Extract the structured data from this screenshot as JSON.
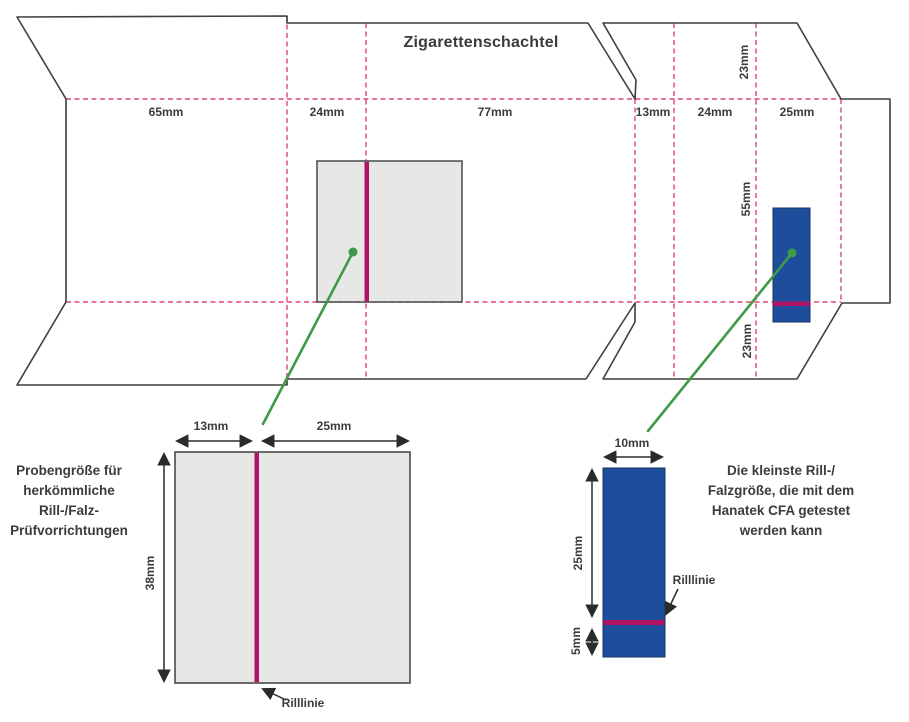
{
  "title": "Zigarettenschachtel",
  "box_template": {
    "panel_widths": [
      "65mm",
      "24mm",
      "77mm",
      "13mm",
      "24mm",
      "25mm"
    ],
    "side_heights": [
      "23mm",
      "55mm",
      "23mm"
    ]
  },
  "left_sample": {
    "caption_lines": [
      "Probengröße für",
      "herkömmliche",
      "Rill-/Falz-",
      "Prüfvorrichtungen"
    ],
    "dim_left": "13mm",
    "dim_right": "25mm",
    "dim_height": "38mm",
    "crease_label": "Rilllinie"
  },
  "right_sample": {
    "caption_lines": [
      "Die kleinste Rill-/",
      "Falzgröße, die mit dem",
      "Hanatek CFA getestet",
      "werden kann"
    ],
    "dim_width": "10mm",
    "dim_upper": "25mm",
    "dim_lower": "5mm",
    "crease_label": "Rilllinie"
  },
  "colors": {
    "fold_line": "#e0476f",
    "crease_line": "#b01366",
    "sample_gray": "#e7e7e5",
    "sample_blue": "#1e4d9b",
    "pointer_green": "#3d9a47",
    "outline": "#3f3f3f",
    "dimension": "#2b2b2b",
    "text": "#3b3b3b"
  }
}
